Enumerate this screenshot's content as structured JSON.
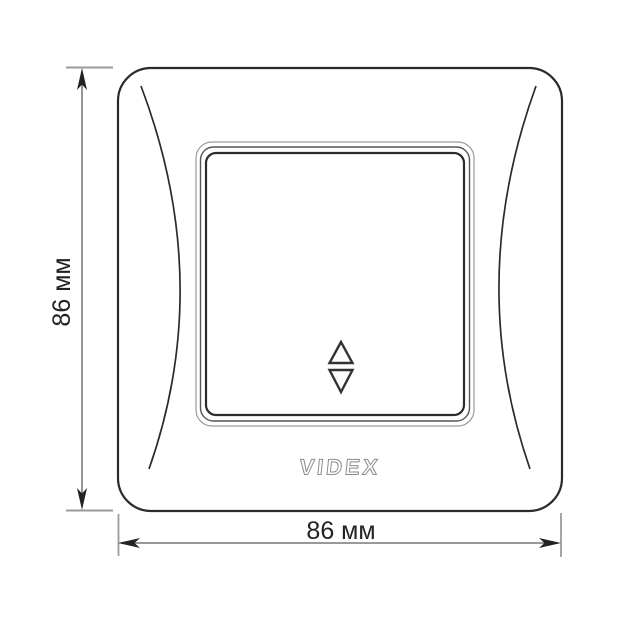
{
  "drawing": {
    "brand_logo": "VIDEX",
    "product": {
      "icons": {
        "rocker_up": "triangle-up-outline",
        "rocker_down": "triangle-down-outline"
      }
    },
    "dimension_height": {
      "label": "86 мм"
    },
    "dimension_width": {
      "label": "86 мм"
    },
    "colors": {
      "background": "#ffffff",
      "outline": "#2b2b2b",
      "dimension_line": "#5c5c5c",
      "extension_tick": "#9b9b9b",
      "arrowhead": "#222222",
      "logo_outline": "#8c8c8c",
      "label_text": "#222222"
    }
  }
}
